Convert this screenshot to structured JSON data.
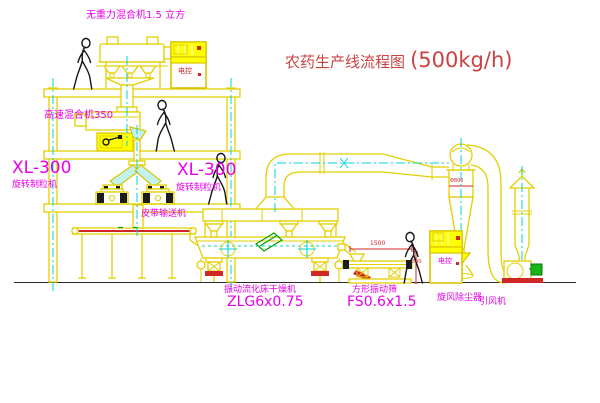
{
  "title": {
    "text": "农药生产线流程图",
    "capacity": "(500kg/h)"
  },
  "labels": {
    "gravity_mixer": "无重力混合机1.5 立方",
    "high_speed_mixer": "高速混合机350",
    "granulator_left_model": "XL-300",
    "granulator_left_name": "旋转制粒机",
    "granulator_right_model": "XL-300",
    "granulator_right_name": "旋转制粒机",
    "belt_conveyor": "皮带输送机",
    "dryer_name": "振动流化床干燥机",
    "dryer_model": "ZLG6x0.75",
    "sieve_name": "方形振动筛",
    "sieve_model": "FS0.6x1.5",
    "cyclone": "旋风除尘器",
    "fan": "引风机",
    "cabinet_top": "电控",
    "cabinet_bottom": "电控"
  },
  "dimensions": {
    "sieve_width": "1500",
    "sieve_height": "540",
    "cyclone_diameter": "Φ800"
  },
  "colors": {
    "equipment_line": "#e3cf00",
    "centerline": "#00d4d4",
    "label_magenta": "#e800e8",
    "title_red": "#c94343",
    "accent_red": "#d22626",
    "accent_green": "#00a000",
    "cabinet_yellow": "#ffff00",
    "people_black": "#161616",
    "background": "#ffffff"
  }
}
